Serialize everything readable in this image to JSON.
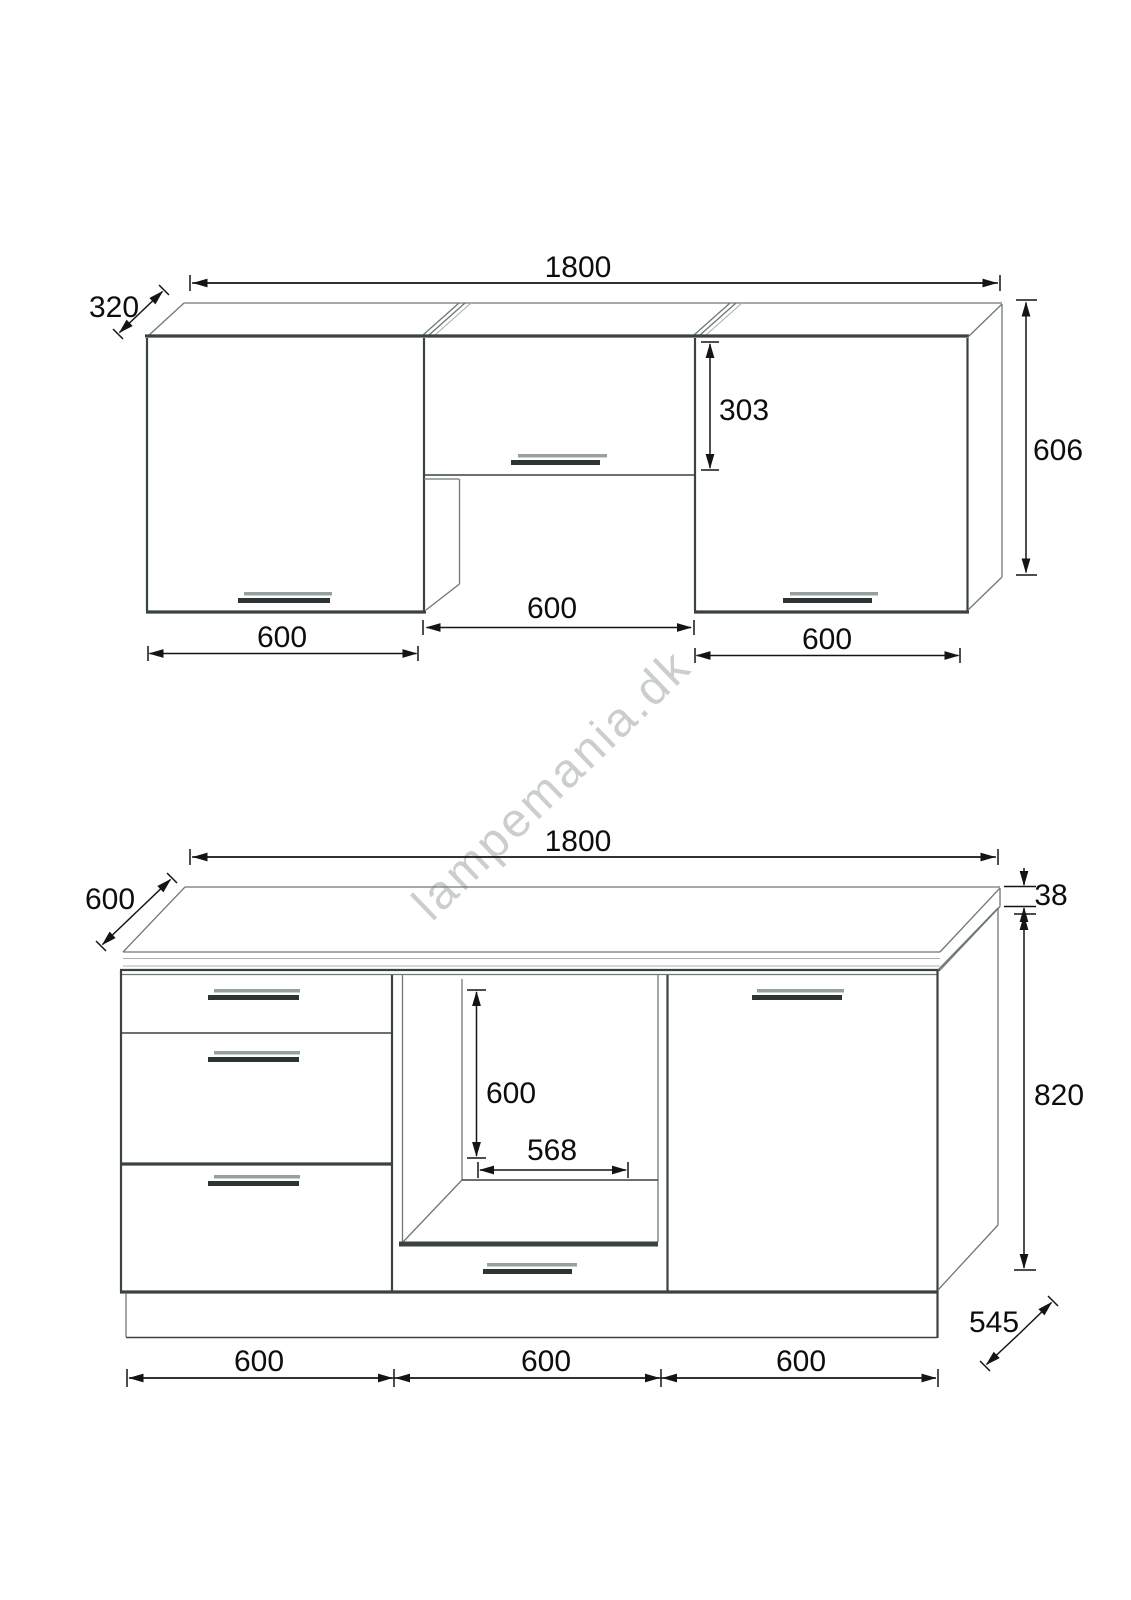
{
  "watermark": "lampemania.dk",
  "colors": {
    "background": "#ffffff",
    "line": "#6e7878",
    "line-light": "#aab2b2",
    "line-dark": "#3a4242",
    "dim": "#141414",
    "text": "#0d0d0d",
    "handle-light": "#97a0a0",
    "handle-dark": "#2c3434",
    "watermark": "#c2c6c6"
  },
  "upper_unit": {
    "total_width": "1800",
    "side_depth": "320",
    "height": "606",
    "flip_door_height": "303",
    "middle_gap_width": "600",
    "left_cabinet_width": "600",
    "right_cabinet_width": "600"
  },
  "lower_unit": {
    "worktop_width": "1800",
    "worktop_depth": "600",
    "worktop_thickness": "38",
    "carcass_height": "820",
    "niche_height": "600",
    "niche_width": "568",
    "base_depth": "545",
    "left_section_width": "600",
    "middle_section_width": "600",
    "right_section_width": "600"
  }
}
